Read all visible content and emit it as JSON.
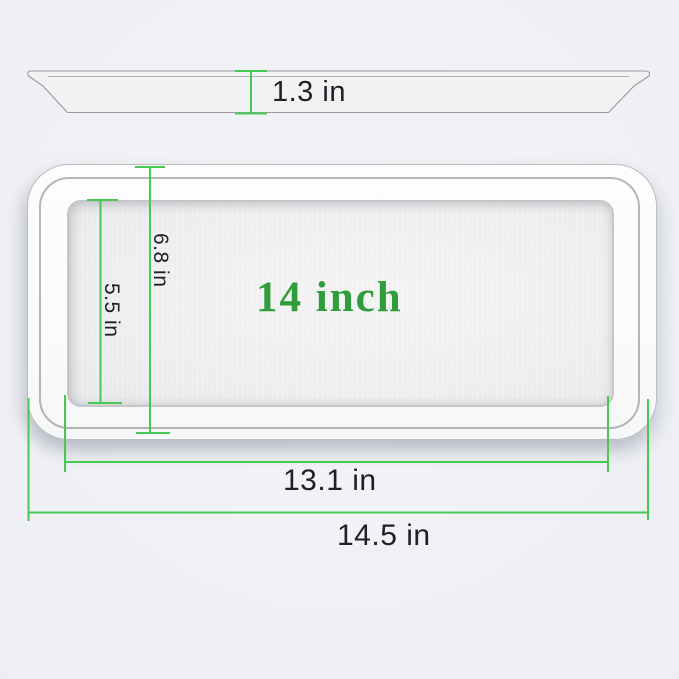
{
  "diagram": {
    "center_label": "14 inch",
    "side_view": {
      "thickness_label": "1.3 in"
    },
    "top_view": {
      "outer_height_label": "6.8 in",
      "inner_height_label": "5.5 in",
      "inner_width_label": "13.1 in",
      "outer_width_label": "14.5 in"
    },
    "colors": {
      "dimension_line_green": "#46c952",
      "size_label_green": "#2f9e3a",
      "measurement_text": "#1f2024",
      "background": "#edeff3",
      "tray_white": "#fcfcfd"
    }
  }
}
